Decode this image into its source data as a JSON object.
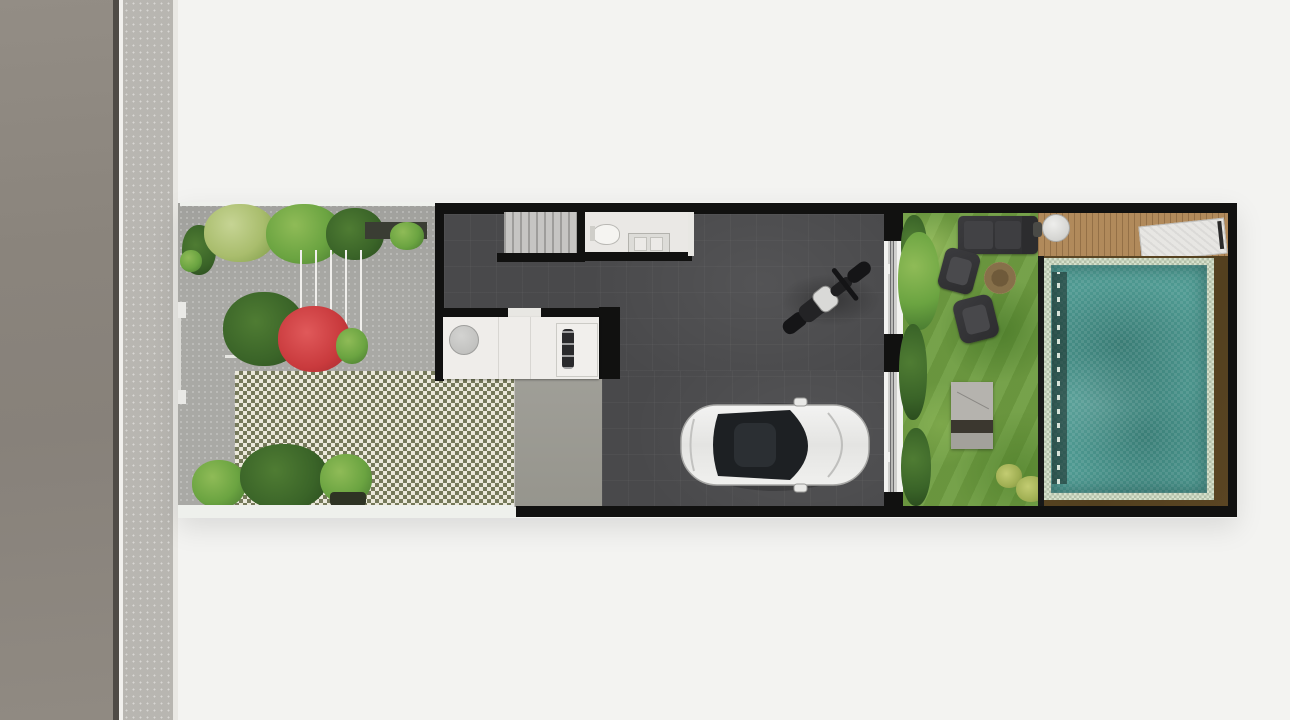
{
  "scene": {
    "type": "architectural-site-plan-top-view",
    "description": "Top-down rendered site plan of a narrow townhouse lot. From left to right: asphalt road, sidewalk, front garden with planting beds and a grass-block paver driveway, dark-floored house volume containing staircase, bathroom, kitchen counter and a carport with a parked white car and a motorcycle, a full-height glass wall, then a rear garden with lawn, lounge furniture, wooden deck and a swimming pool framed by a dark timber surround and black boundary walls.",
    "contains_text": false
  },
  "street": {
    "road": "asphalt road strip",
    "curb": "curb edge line",
    "sidewalk": "speckled concrete sidewalk"
  },
  "front_garden": {
    "label": "front garden and driveway",
    "objects": [
      {
        "name": "shrub-row-top",
        "color": "#6ba441"
      },
      {
        "name": "dark-planting-strip",
        "color": "#3a3d33"
      },
      {
        "name": "stepping-stone-path",
        "color": "#f0efec"
      },
      {
        "name": "green-planter-shrub",
        "color": "#3f7030"
      },
      {
        "name": "red-bougainvillea",
        "color": "#c93a3d"
      },
      {
        "name": "round-bush",
        "color": "#3da04b"
      },
      {
        "name": "grass-block-paver-driveway",
        "colors": [
          "#75795a",
          "#ebe9db"
        ]
      },
      {
        "name": "palm-planting-bed-bottom",
        "color": "#4a8a35"
      },
      {
        "name": "entry-gate-posts",
        "color": "#e9e9e6"
      }
    ]
  },
  "house": {
    "label": "house ground floor",
    "wall_color": "#111110",
    "floor_color": "#49494b",
    "rooms": [
      {
        "name": "staircase",
        "tread_color": "#c6c5c3"
      },
      {
        "name": "bathroom",
        "fixtures": [
          "toilet",
          "vanity-cabinet"
        ],
        "floor_color": "#eae8e5"
      },
      {
        "name": "kitchen-counter",
        "fixtures": [
          "round-sink-table",
          "cooktop"
        ],
        "color": "#efedea"
      },
      {
        "name": "carport-garage",
        "apron_color": "#9b9a92"
      }
    ],
    "vehicles": [
      {
        "name": "white-car-top-view",
        "body_color": "#ececeb",
        "glass_color": "#1d2023",
        "facing": "right"
      },
      {
        "name": "motorcycle",
        "color": "#18181a",
        "orientation": "diagonal-front-upper-right"
      }
    ],
    "glass_wall": {
      "name": "rear-sliding-glass-wall",
      "frame_color": "#111110",
      "track_color": "#cfcfcd"
    }
  },
  "backyard": {
    "label": "rear garden",
    "objects": [
      {
        "name": "lawn",
        "color": "#6f9d41"
      },
      {
        "name": "hedge-along-glass-wall",
        "color": "#3a6428"
      },
      {
        "name": "garden-tree",
        "color": "#6ba441"
      },
      {
        "name": "outdoor-sofa",
        "color": "#323234"
      },
      {
        "name": "armchair-upper",
        "color": "#38383a"
      },
      {
        "name": "armchair-lower",
        "color": "#3a3a3c"
      },
      {
        "name": "fire-pit",
        "color": "#87704a"
      },
      {
        "name": "garden-bench-steps",
        "colors": [
          "#b5b3ae",
          "#3b372f"
        ]
      },
      {
        "name": "yellow-green-bushes",
        "color": "#9fae52"
      },
      {
        "name": "wooden-deck",
        "color": "#b18a5b"
      },
      {
        "name": "round-side-table",
        "color": "#d4d4d1"
      },
      {
        "name": "sun-lounger",
        "color": "#e7e6e3"
      },
      {
        "name": "deck-steps",
        "color": "#8a6b44"
      }
    ]
  },
  "pool": {
    "label": "swimming pool",
    "water_color": "#4f9a92",
    "coping_color": "#d5e0cb",
    "surround_color": "#53401f",
    "shadow_band_color": "#22332e"
  },
  "colors": {
    "background": "#f3f3f1",
    "road": "#8b857d",
    "road_edge": "#4f4b46",
    "sidewalk": "#b8b6b1",
    "paving": "#a9a9a5",
    "paver_olive": "#75795a",
    "paver_cream": "#ebe9db",
    "wall": "#111110",
    "floor": "#49494b",
    "lawn": "#6f9d41",
    "deck_wood": "#b18a5b",
    "pool_water": "#4f9a92",
    "pool_coping": "#d5e0cb"
  }
}
